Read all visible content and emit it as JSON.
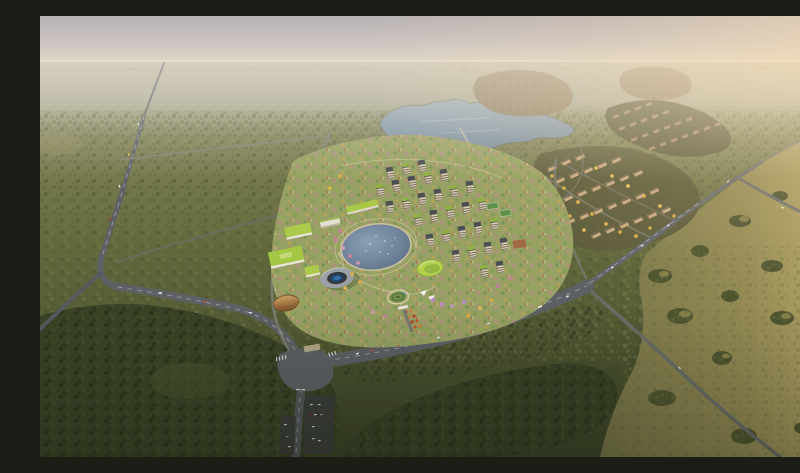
{
  "page": {
    "title": "Aerial master-plan rendering"
  },
  "scene": {
    "aria_label": "Bird's-eye architectural rendering of a forested eco-community",
    "description": "Bird's-eye architectural rendering, hazy late-afternoon light: a master-planned community of cream mid-rise apartment blocks around a circular lake with a ring-shaped pool building, lime-green-roofed campus buildings and a brown domed hall; a large natural lake and distant village clusters to the north; beige residential clusters with golden autumn trees to the east; roads winding through dense woodland toward a sunlit golden meadow and a pale pink horizon.",
    "elements": {
      "water": [
        "large natural lake (north)",
        "small pond",
        "circular lake (center of development)",
        "ring-building pool"
      ],
      "buildings": [
        "apartment towers with cream facades and green or dark roofs",
        "lime green-roof campus blocks",
        "round ring building with blue pool",
        "brown ribbed dome hall",
        "green oval roof pavilion",
        "east residential slab clusters",
        "terraced housing cluster",
        "distant brown-roof villages"
      ],
      "infrastructure": [
        "left straight highway",
        "west avenue",
        "main road intersection with crosswalks",
        "wide east avenue",
        "crossroads",
        "northeast road",
        "meadow road",
        "parking lots with cars",
        "entrance gate promenade"
      ],
      "landscape": [
        "dense olive forest",
        "dark foreground woods",
        "golden sunlit meadow with tree clumps",
        "sports courts",
        "garden circle",
        "pink and yellow ornamental trees"
      ]
    },
    "palette": {
      "sky_top": "#b7b1b4",
      "sky_horizon": "#e4dac6",
      "sun_glow": "#ffe2b2",
      "distant_plain": "#a9a794",
      "forest_mid": "#646a3e",
      "forest_dark": "#3a4227",
      "meadow_gold": "#a89c60",
      "lake_water": "#8095aa",
      "circular_lake": "#6d8199",
      "pool_blue": "#1d4d7e",
      "road_asphalt": "#5d6165",
      "lane_dash": "#d7dadc",
      "site_ground": "#99a065",
      "walkway": "#cfc6a0",
      "roof_green": "#a9c947",
      "roof_dark": "#4b4f53",
      "facade_cream": "#d9cfb6",
      "facade_tan": "#c6aa80",
      "tree_yellow": "#d8ab49",
      "tree_pink": "#cb7f9c",
      "tree_red": "#c05a32",
      "dome_brown": "#9a6332"
    }
  }
}
